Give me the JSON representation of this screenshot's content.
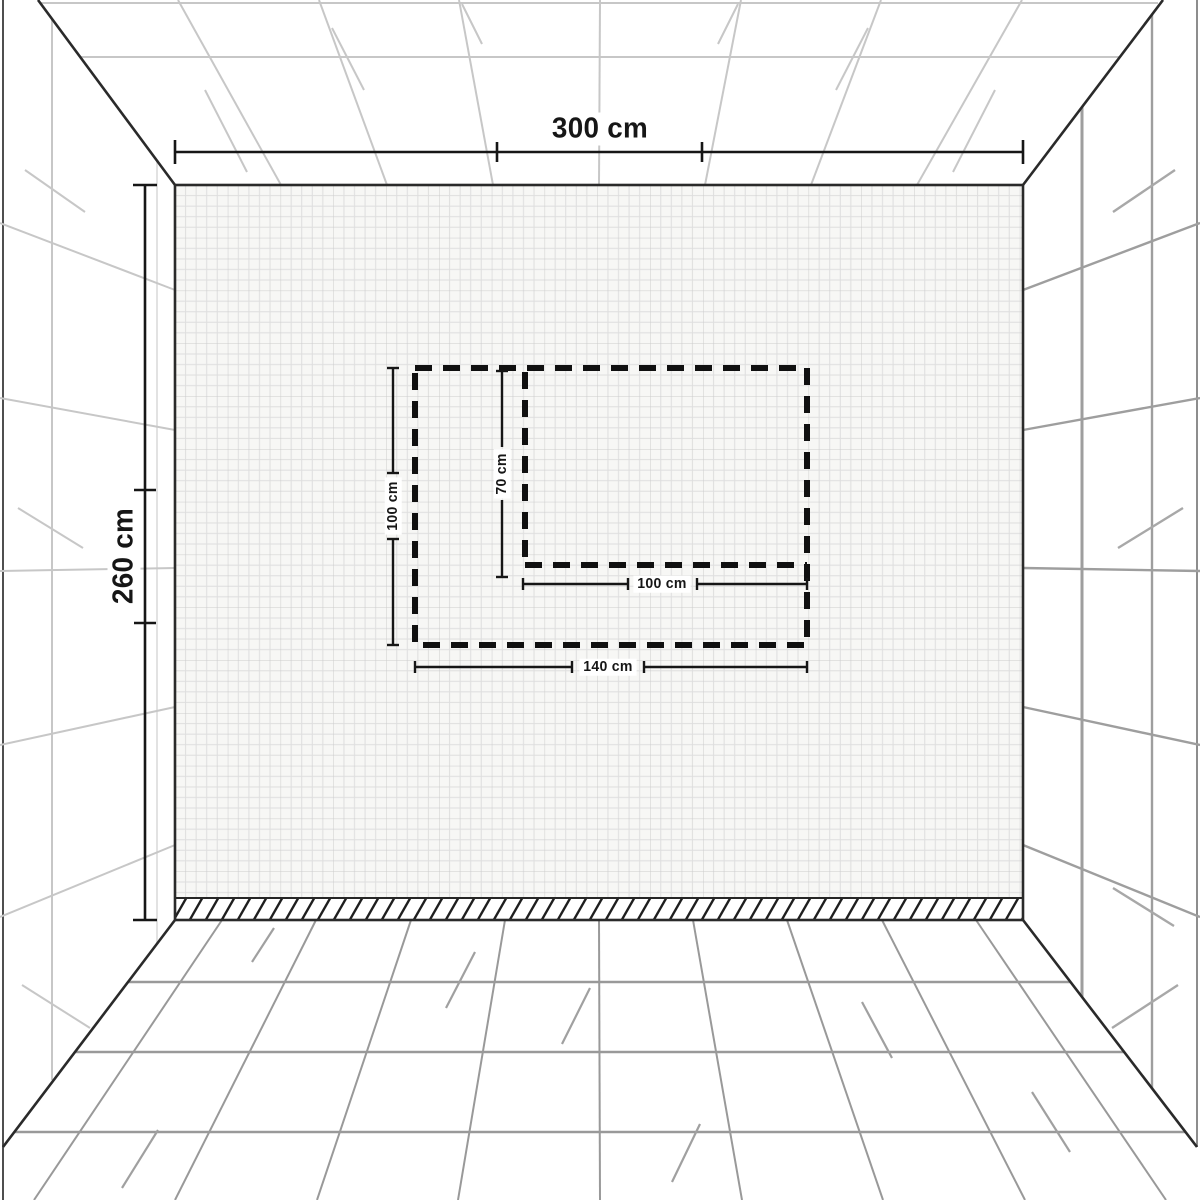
{
  "diagram": {
    "type": "room-perspective-wall-measurement-diagram",
    "wall": {
      "width_label": "300 cm",
      "height_label": "260 cm"
    },
    "marked_areas": [
      {
        "name": "outer-dashed-area",
        "width_label": "140 cm",
        "height_label": "100 cm"
      },
      {
        "name": "inner-dashed-area",
        "width_label": "100 cm",
        "height_label": "70 cm"
      }
    ],
    "colors": {
      "structural_line": "#2a2a2a",
      "dimension_line": "#161616",
      "dashed_area_line": "#101010",
      "wall_grid_line": "#dcdcdc",
      "wall_fill": "#f7f7f5",
      "tile_line_light": "#c7c7c7",
      "tile_line_dark": "#999999"
    }
  }
}
